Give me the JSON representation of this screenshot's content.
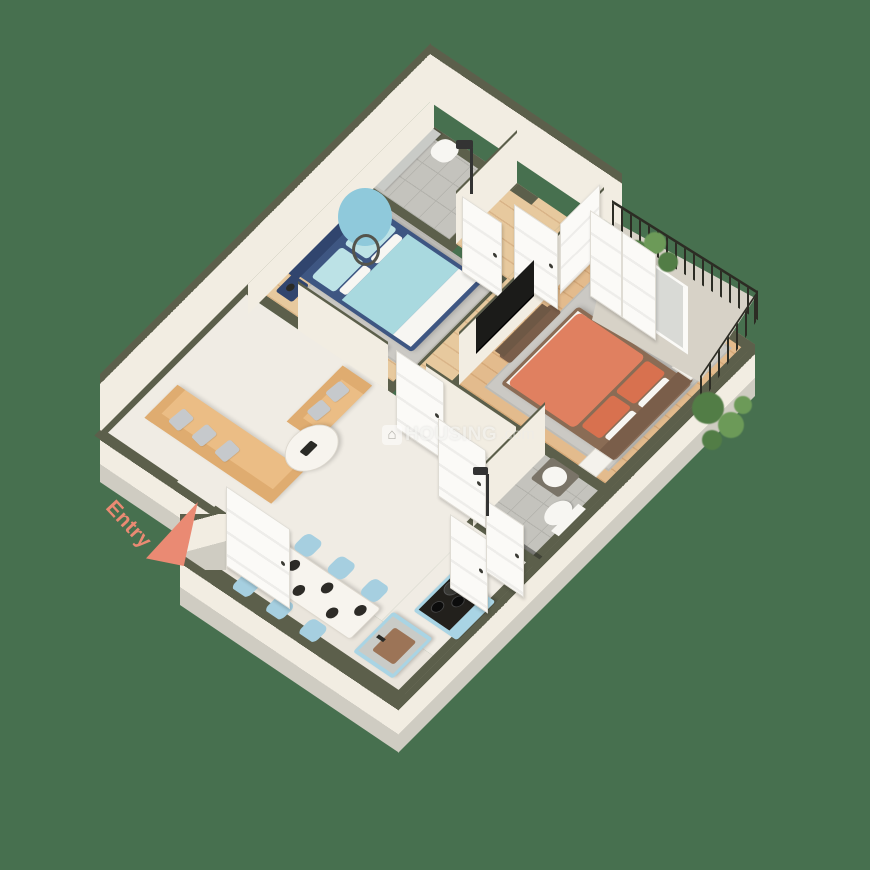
{
  "title": "3D isometric floor plan render - 2 bedroom apartment",
  "background_color": "#47704F",
  "entry": {
    "label": "Entry",
    "color": "#EA8A73"
  },
  "watermark": {
    "icon_glyph": "⌂",
    "brand": "HOUSING",
    "suffix": ".com"
  },
  "palette": {
    "bg": "#47704F",
    "cap": "#5C5F4B",
    "face": "#F2EDE2",
    "slab": "#CFCCC2",
    "marble": "#F0ECE4",
    "marble2": "#EAE5DC",
    "wood": "#E7C99E",
    "woodline": "#D9B488",
    "wood2": "#E3BB8D",
    "woodline2": "#D5A878",
    "tile": "#C4C3BD",
    "grout": "#B2B1AB",
    "balcony": "#D7D2C7",
    "door": "#FBFAF7",
    "dooredge": "#DFDCD4",
    "navy": "#3E5682",
    "navydark": "#31456E",
    "cyan": "#A9D9DF",
    "cyanlight": "#BCE2E6",
    "whitefab": "#F7F6F2",
    "rug": "#CBC9C4",
    "tan": "#EBBD85",
    "tandark": "#DFAC70",
    "pgray": "#C6C9CC",
    "tablewhite": "#F7F4EE",
    "chairblue": "#A6CFE0",
    "plate": "#2D2B27",
    "kblue": "#A9D4E4",
    "ktop": "#C9CBC7",
    "sinkbrown": "#9C7457",
    "stove": "#22201C",
    "coral": "#E08060",
    "coraldark": "#D8714F",
    "hbrown": "#8A6C55",
    "hbrown2": "#7A5E4A",
    "wfurn": "#F4F2EC",
    "mirror": "#8FC9DB",
    "plantc": "#527D46",
    "plantc2": "#6C9A58",
    "rail": "#2C2C24",
    "dark": "#2A2A26",
    "salmon": "#EA8A73"
  },
  "rooms": [
    {
      "key": "living-room",
      "floor": "marble",
      "furniture": [
        "l-sofa-long",
        "l-sofa-short",
        "gray-throw-pillows",
        "round-marble-coffee-table"
      ]
    },
    {
      "key": "dining-area",
      "floor": "marble",
      "furniture": [
        "marble-dining-table",
        "six-blue-chairs",
        "black-plates"
      ]
    },
    {
      "key": "kitchen",
      "floor": "marble",
      "furniture": [
        "blue-sink-island",
        "blue-stove-counter",
        "gas-hob",
        "pots"
      ]
    },
    {
      "key": "bedroom-1",
      "floor": "wood",
      "furniture": [
        "navy-double-bed",
        "light-blue-bedding",
        "navy-nightstand",
        "navy-daybed-bench",
        "round-blue-mirror",
        "gray-rug"
      ]
    },
    {
      "key": "bedroom-2",
      "floor": "wood",
      "furniture": [
        "coral-double-bed",
        "brown-headboard",
        "white-nightstands",
        "brown-bench",
        "tv-unit",
        "gray-rug"
      ]
    },
    {
      "key": "bathroom-1",
      "floor": "tile",
      "furniture": [
        "shower",
        "stone-counter",
        "washbasin"
      ]
    },
    {
      "key": "bathroom-2",
      "floor": "tile",
      "furniture": [
        "shower",
        "washbasin",
        "toilet",
        "glass-partition"
      ]
    },
    {
      "key": "hallway",
      "floor": "wood",
      "furniture": [
        "white-doors",
        "wardrobe"
      ]
    },
    {
      "key": "balcony",
      "floor": "concrete",
      "furniture": [
        "iron-railing",
        "plants"
      ]
    }
  ]
}
